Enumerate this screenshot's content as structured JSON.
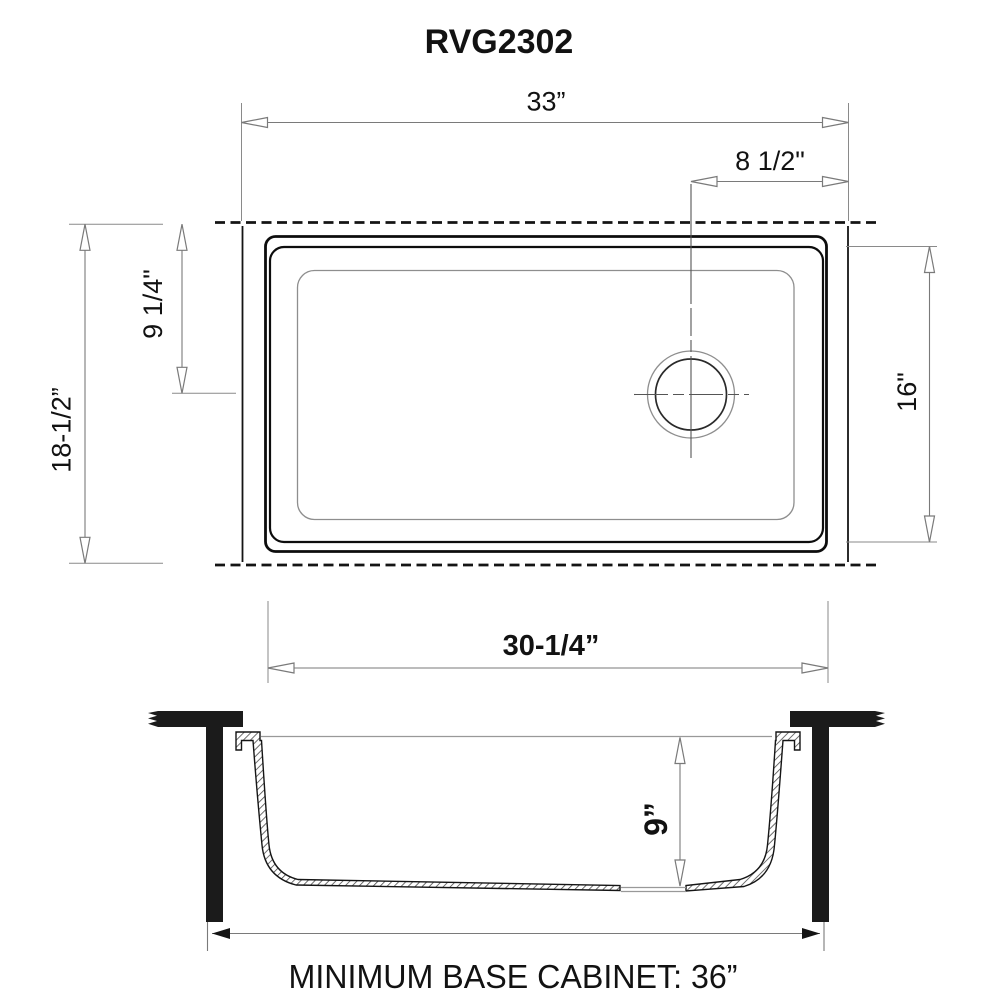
{
  "title": "RVG2302",
  "top_view": {
    "overall_width_label": "33”",
    "drain_offset_label": "8 1/2\"",
    "overall_depth_label": "18-1/2”",
    "drain_from_top_label": "9 1/4\"",
    "inner_depth_label": "16\"",
    "rim_width_label": "30-1/4”"
  },
  "section_view": {
    "bowl_depth_label": "9”",
    "cabinet_label": "MINIMUM BASE CABINET: 36”"
  },
  "colors": {
    "line": "#111111",
    "dim_line": "#7a7a7a",
    "thin_line": "#999999",
    "solid_fill": "#1b1b1b",
    "background": "#ffffff"
  }
}
